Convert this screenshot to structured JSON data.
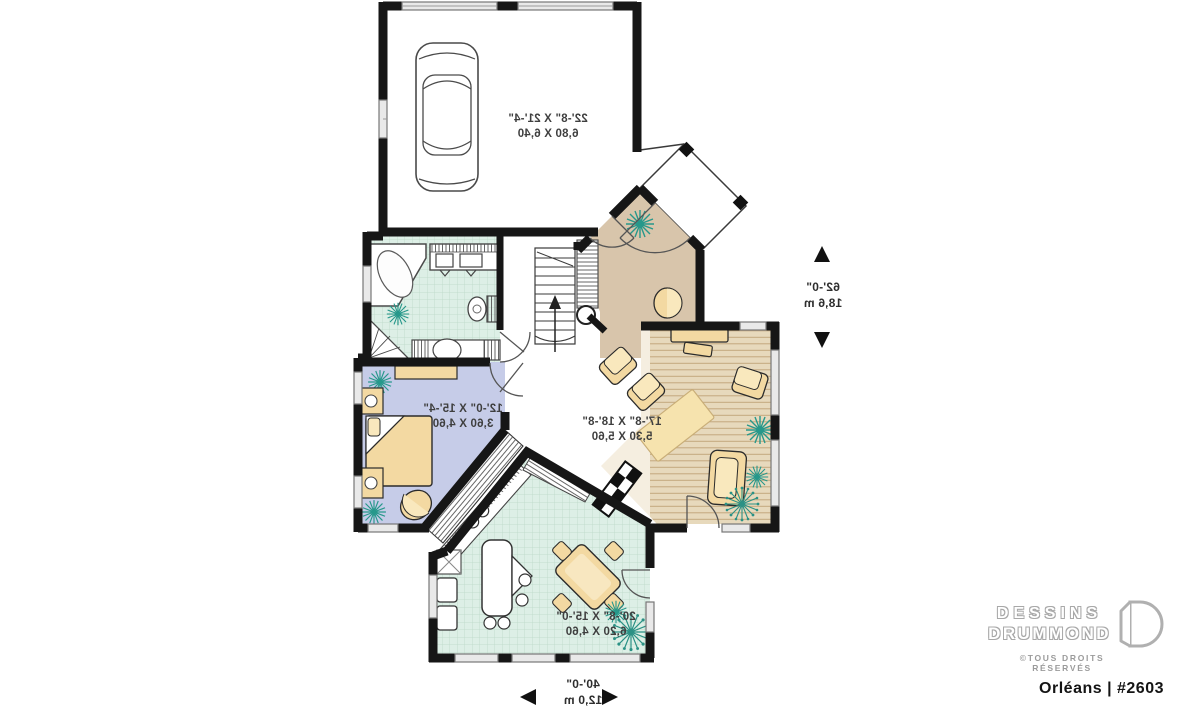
{
  "plan": {
    "text_direction": "mirrored",
    "room_labels": {
      "garage": {
        "imperial": "22'-8\" X 21'-4\"",
        "metric": "6,80 X 6,40"
      },
      "living_room": {
        "imperial": "17'-8\" X 18'-8\"",
        "metric": "5,30 X 5,60"
      },
      "bedroom": {
        "imperial": "12'-0\" X 15'-4\"",
        "metric": "3,60 X 4,60"
      },
      "kitchen_dining": {
        "imperial": "20'-8\" X 15'-0\"",
        "metric": "6,20 X 4,60"
      }
    },
    "overall_dimensions": {
      "width": {
        "imperial": "40'-0\"",
        "metric": "12,0 m"
      },
      "depth": {
        "imperial": "62'-0\"",
        "metric": "18,6 m"
      }
    },
    "symbols": [
      "garage-car",
      "corner-bathtub",
      "double-vanity",
      "toilet",
      "corner-shower",
      "staircase-up-arrow",
      "double-bed",
      "nightstand",
      "dresser",
      "bedroom-closet",
      "kitchen-island",
      "refrigerator",
      "range",
      "kitchen-sink",
      "dining-table",
      "sofa-console",
      "armchair",
      "loveseat",
      "area-rug",
      "fireplace",
      "houseplant",
      "front-porch",
      "entry-door"
    ],
    "colors": {
      "wall": "#161616",
      "foyer_floor": "#d8c5ab",
      "living_wood_floor": "#e7d9bc",
      "bedroom_floor": "#c6cce8",
      "tile_floor": "#ddefe6",
      "furniture": "#f3d9a2",
      "plant": "#27988b",
      "window": "#8f8f8f"
    }
  },
  "branding": {
    "name_line1": "DESSINS",
    "name_line2": "DRUMMOND",
    "rights": "©TOUS DROITS RÉSERVÉS",
    "model": "Orléans | #2603"
  }
}
